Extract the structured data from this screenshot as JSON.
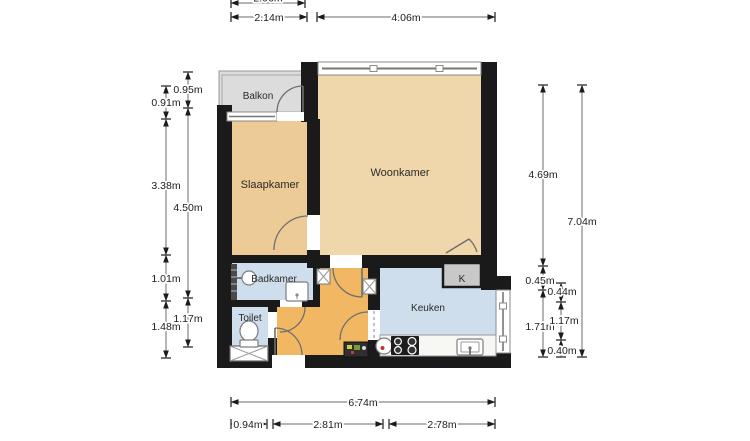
{
  "plan": {
    "type": "apartment-floorplan",
    "rooms": {
      "balkon": "Balkon",
      "slaapkamer": "Slaapkamer",
      "woonkamer": "Woonkamer",
      "badkamer": "Badkamer",
      "toilet": "Toilet",
      "keuken": "Keuken",
      "kast": "K"
    }
  },
  "colors": {
    "walls": "#1a1a1a",
    "woonkamer": "#f0d7ab",
    "slaapkamer": "#eccb96",
    "hall": "#f2b763",
    "wetroom": "#cfdeed",
    "balkon": "#dcdcdc",
    "kast": "#c8c8c8",
    "counter": "#f7f7f3",
    "stove": "#1d1d1d",
    "dim_text": "#1c1c1c"
  },
  "dims": {
    "top_clipped": "2.06m",
    "top": [
      "2.14m",
      "4.06m"
    ],
    "left_outer": [
      "0.91m",
      "3.38m",
      "1.01m",
      "1.48m"
    ],
    "left_inner": [
      "0.95m",
      "4.50m",
      "1.17m"
    ],
    "right_inner": [
      "4.69m",
      "0.45m",
      "1.71m"
    ],
    "right_mid": [
      "0.44m",
      "1.17m",
      "0.40m"
    ],
    "right_outer": [
      "7.04m"
    ],
    "bottom_total": [
      "6.74m"
    ],
    "bottom": [
      "0.94m",
      "2.81m",
      "2.78m"
    ]
  }
}
